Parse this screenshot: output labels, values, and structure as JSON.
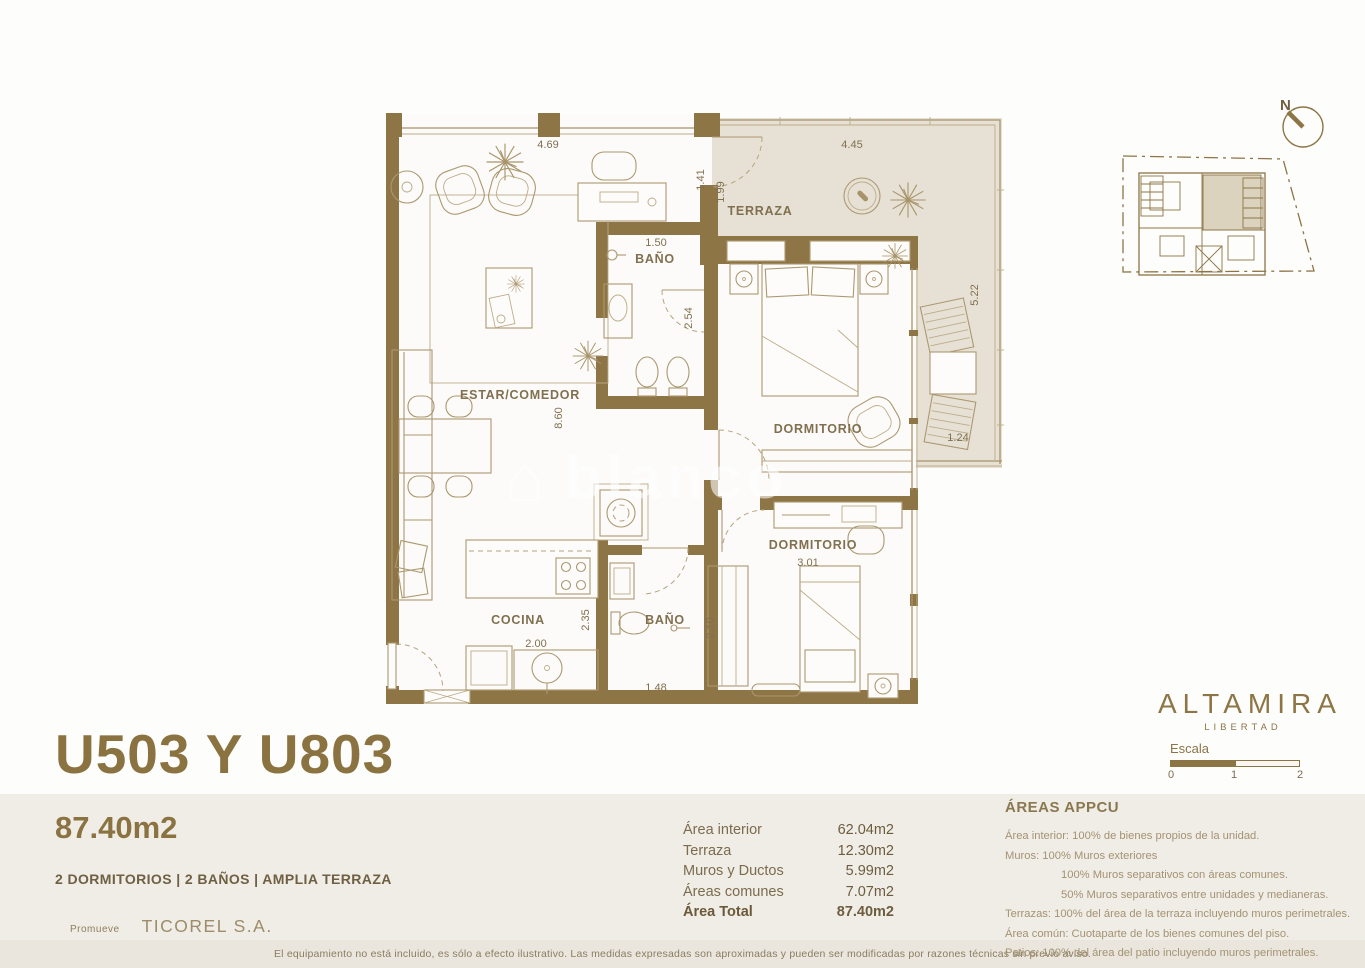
{
  "unit": {
    "code": "U503 Y U803",
    "total_area": "87.40m2",
    "features": "2 DORMITORIOS  | 2 BAÑOS | AMPLIA TERRAZA",
    "promoter_label": "Promueve",
    "promoter_name": "TICOREL S.A."
  },
  "areas_table": {
    "rows": [
      {
        "label": "Área interior",
        "value": "62.04m2"
      },
      {
        "label": "Terraza",
        "value": "12.30m2"
      },
      {
        "label": "Muros y Ductos",
        "value": "5.99m2"
      },
      {
        "label": "Áreas comunes",
        "value": "7.07m2"
      },
      {
        "label": "Área Total",
        "value": "87.40m2"
      }
    ]
  },
  "appcu": {
    "title": "ÁREAS APPCU",
    "lines": [
      {
        "text": "Área interior: 100% de bienes propios de la unidad."
      },
      {
        "text": "Muros: 100% Muros exteriores"
      },
      {
        "text": "100% Muros separativos con áreas comunes."
      },
      {
        "text": "50%  Muros separativos entre unidades  y medianeras."
      },
      {
        "text": "Terrazas: 100% del área de la terraza incluyendo muros perimetrales."
      },
      {
        "text": "Área común: Cuotaparte de los bienes comunes del piso."
      },
      {
        "text": "Patios: 100% del área del patio incluyendo muros perimetrales."
      }
    ]
  },
  "brand": {
    "name": "ALTAMIRA",
    "tagline": "LIBERTAD"
  },
  "scalebar": {
    "label": "Escala",
    "ticks": [
      "0",
      "1",
      "2"
    ]
  },
  "compass": {
    "label": "N"
  },
  "plan": {
    "rooms": {
      "living": "ESTAR/COMEDOR",
      "bath1": "BAÑO",
      "terrace": "TERRAZA",
      "bedroom1": "DORMITORIO",
      "bedroom2": "DORMITORIO",
      "kitchen": "COCINA",
      "bath2": "BAÑO"
    },
    "dims": {
      "top_living": "4.69",
      "top_terrace": "4.45",
      "right_living": "1.41",
      "terrace_left": "1.99",
      "bath1_width": "1.50",
      "bath1_height": "2.54",
      "living_height": "8.60",
      "terrace_right": "5.22",
      "terrace_bottom": "1.24",
      "bedroom2_width": "3.01",
      "kitchen_height": "2.35",
      "kitchen_width": "2.00",
      "bath2_height": "2.10",
      "bath2_width": "1.48"
    }
  },
  "watermark": "blanco",
  "footer": {
    "disclaimer": "El equipamiento no está incluido, es sólo a efecto ilustrativo. Las medidas expresadas son aproximadas y pueden ser modificadas por razones técnicas sin previo aviso."
  },
  "colors": {
    "accent": "#8a7340",
    "wall": "#8d7545",
    "terrace_fill": "#e7e1d5",
    "panel_bg": "#f0ece6"
  }
}
